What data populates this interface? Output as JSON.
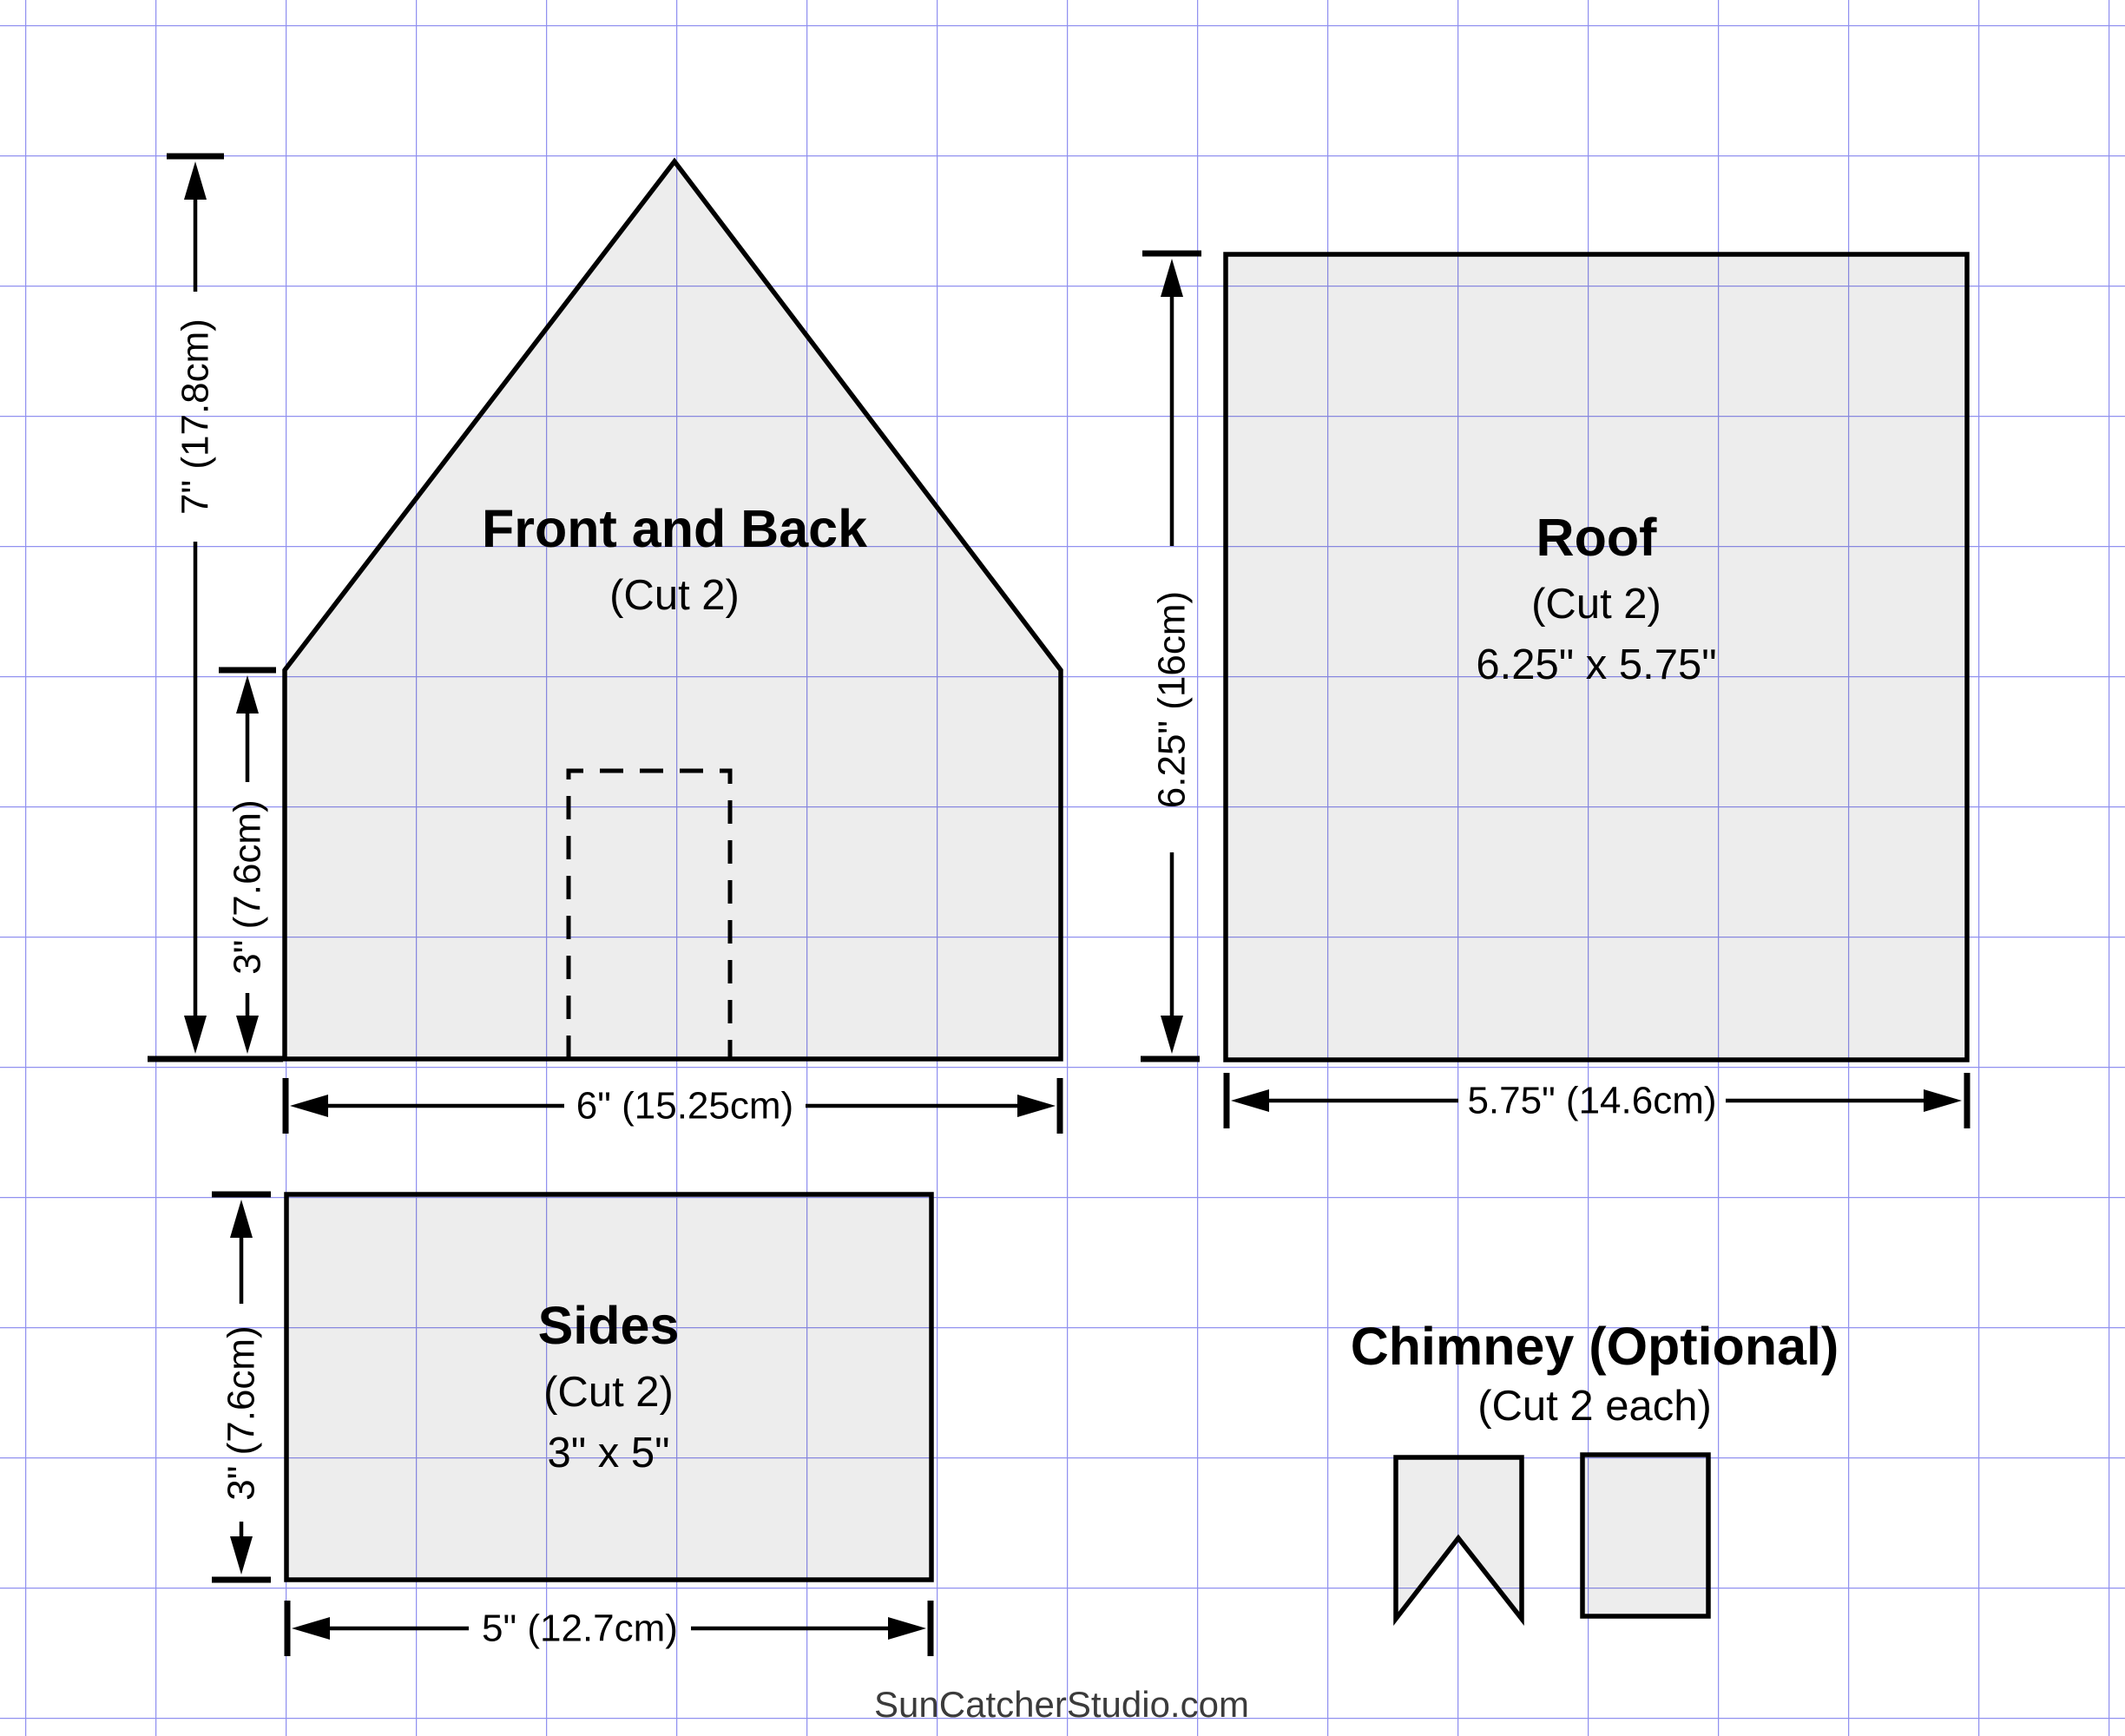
{
  "title": "Gingerbread house template pattern",
  "colors": {
    "background": "#ffffff",
    "grid_line": "#9191f0",
    "piece_fill": "#ececec",
    "piece_outline": "#000000",
    "dimension_line": "#000000",
    "text": "#000000",
    "watermark_text": "#3b3b3b"
  },
  "pieces": {
    "front_back": {
      "title": "Front and Back",
      "subtitle": "(Cut 2)"
    },
    "roof": {
      "title": "Roof",
      "subtitle": "(Cut 2)",
      "size": "6.25\" x 5.75\""
    },
    "sides": {
      "title": "Sides",
      "subtitle": "(Cut 2)",
      "size": "3\" x 5\""
    },
    "chimney": {
      "title": "Chimney (Optional)",
      "subtitle": "(Cut 2 each)"
    }
  },
  "dimensions": {
    "front_back_total_height": "7\" (17.8cm)",
    "front_back_wall_height": "3\" (7.6cm)",
    "front_back_width": "6\" (15.25cm)",
    "roof_height": "6.25\" (16cm)",
    "roof_width": "5.75\" (14.6cm)",
    "sides_height": "3\" (7.6cm)",
    "sides_width": "5\" (12.7cm)"
  },
  "watermark": {
    "text": "SunCatcherStudio.com"
  }
}
